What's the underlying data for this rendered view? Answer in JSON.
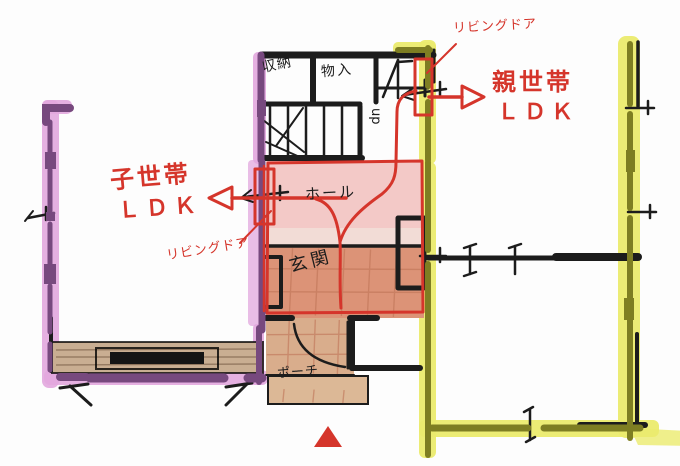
{
  "colors": {
    "ink": "#1c1c1c",
    "red": "#d5352b",
    "purple_light": "#e2a7de",
    "purple_dark": "#77497e",
    "yellow_light": "#ebeb6e",
    "yellow_dark": "#7e7e22",
    "hall_pink": "#f3c9c7",
    "hall_strip": "#f2dcd6",
    "genkan_salmon": "#dc9377",
    "tile_line": "#bf7457",
    "porch_tan": "#d9ad8c",
    "step_tan": "#dcb896",
    "deck_tan": "#c9ae92"
  },
  "labels": {
    "storage": "収納",
    "closet": "物入",
    "stairs_up": "up",
    "hall": "ホール",
    "entrance": "玄関",
    "porch": "ポーチ",
    "living_door_top": "リビングドア",
    "living_door_bottom": "リビングドア",
    "parent_unit_line1": "親世帯",
    "parent_unit_line2": "ＬＤＫ",
    "child_unit_line1": "子世帯",
    "child_unit_line2": "ＬＤＫ"
  }
}
